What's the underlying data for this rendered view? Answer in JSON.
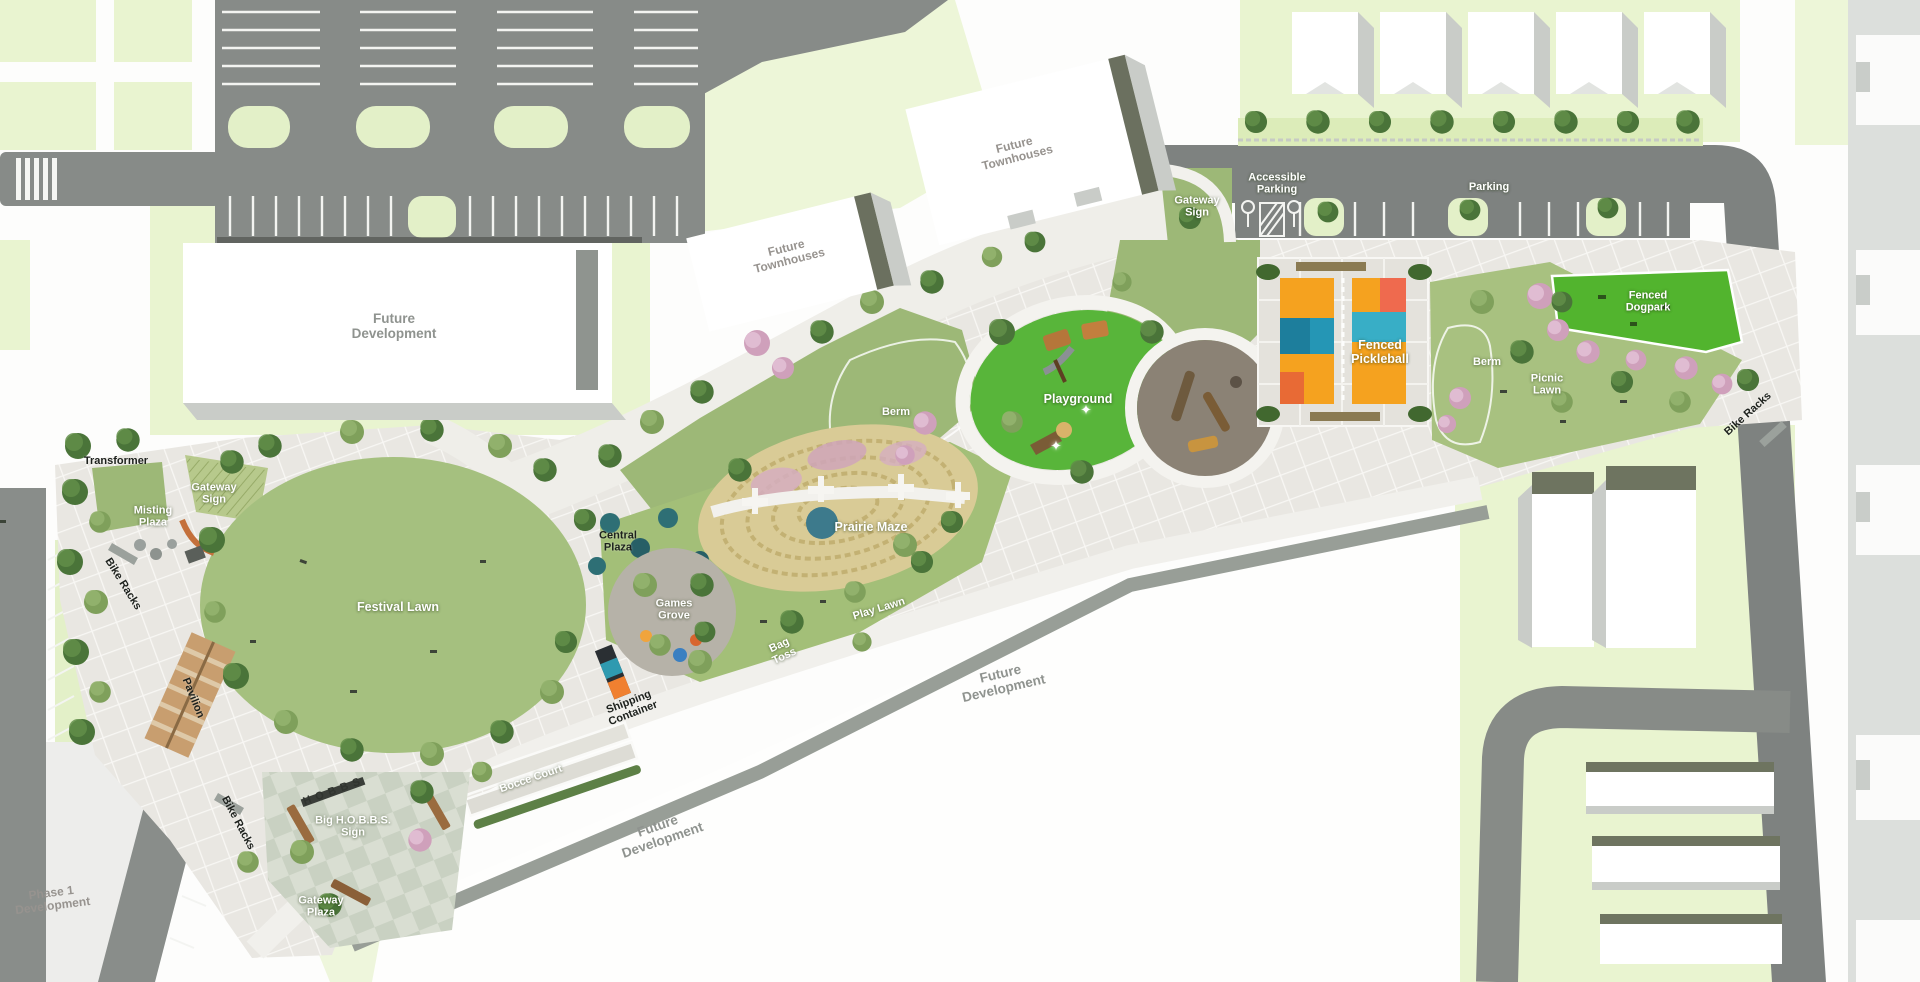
{
  "map_title": "Park master plan site map",
  "labels": {
    "future_development_nw": "Future Development",
    "future_townhouses_1": "Future Townhouses",
    "future_townhouses_2": "Future Townhouses",
    "future_development_bottom": "Future Development",
    "future_development_right": "Future Development",
    "phase_1_development": "Phase 1 Development",
    "gateway_sign_top": "Gateway Sign",
    "gateway_sign_left": "Gateway Sign",
    "accessible_parking": "Accessible Parking",
    "parking": "Parking",
    "fenced_dogpark": "Fenced Dogpark",
    "berm_right": "Berm",
    "berm_center": "Berm",
    "picnic_lawn": "Picnic Lawn",
    "bike_racks_right": "Bike Racks",
    "bike_racks_left": "Bike Racks",
    "bike_racks_bottom": "Bike Racks",
    "fenced_pickleball": "Fenced Pickleball",
    "playground": "Playground",
    "prairie_maze": "Prairie Maze",
    "central_plaza": "Central Plaza",
    "games_grove": "Games Grove",
    "festival_lawn": "Festival Lawn",
    "play_lawn": "Play Lawn",
    "bag_toss": "Bag Toss",
    "transformer": "Transformer",
    "misting_plaza": "Misting Plaza",
    "pavilion": "Pavilion",
    "shipping_container": "Shipping Container",
    "bocce_court": "Bocce Court",
    "big_hobbs_sign": "Big H.O.B.B.S. Sign",
    "gateway_plaza": "Gateway Plaza",
    "hobbs_sign_letters": "HOBBS"
  },
  "icons": {
    "sparkle_glyph": "✦"
  },
  "colors": {
    "road": "#828683",
    "road_dark": "#7c807d",
    "park_paving": "#e9e7e2",
    "lawn": "#a5bf7d",
    "lawn_dark": "#9db877",
    "playground_green": "#58b53a",
    "dogpark_green": "#52b42e",
    "court_orange": "#f5a21f",
    "court_teal": "#2b9ab8",
    "grass_light": "#e9f4d0",
    "building_white": "#ffffff",
    "building_shadow": "#c9ccc8",
    "pink_planting": "#d5a8c2",
    "tree_green": "#4a7439",
    "prairie_tan": "#d9cb96",
    "plaza_brown": "#8b8275",
    "label_gray": "#8f938f"
  }
}
